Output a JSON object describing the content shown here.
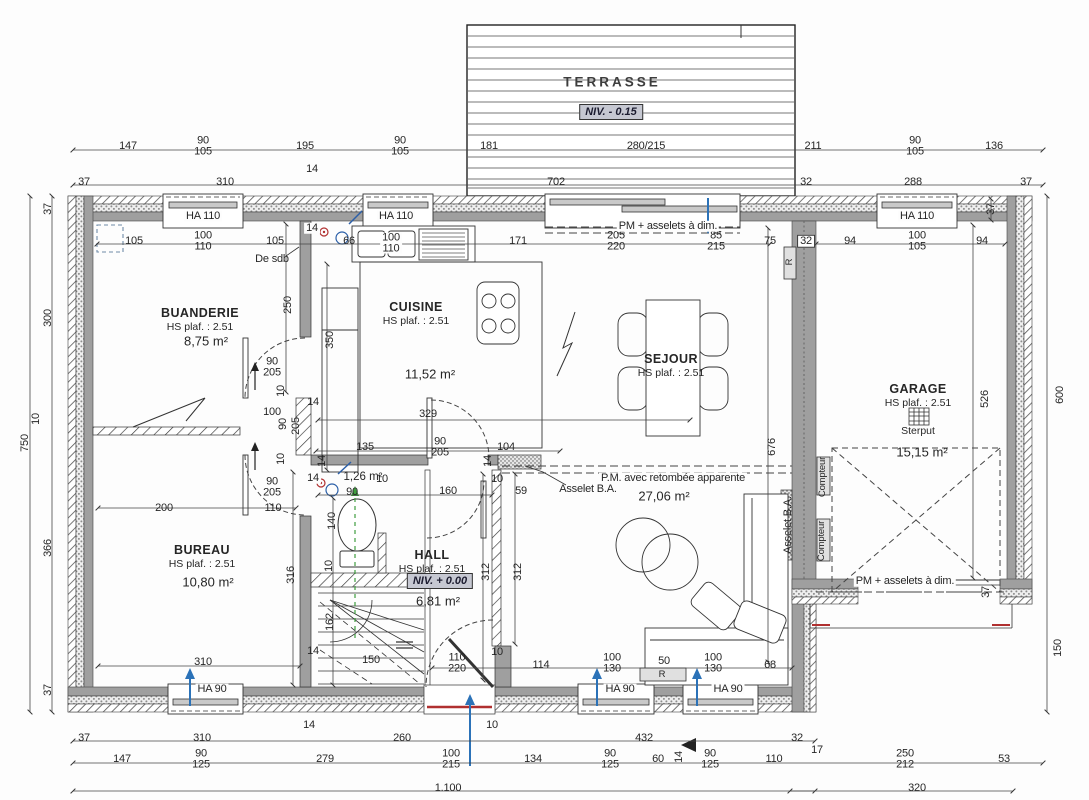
{
  "rooms": {
    "terrasse": {
      "name": "TERRASSE",
      "niv": "NIV. - 0.15"
    },
    "buanderie": {
      "name": "BUANDERIE",
      "ceiling": "HS plaf. : 2.51",
      "area": "8,75 m²"
    },
    "cuisine": {
      "name": "CUISINE",
      "ceiling": "HS plaf. : 2.51",
      "area": "11,52 m²"
    },
    "sejour": {
      "name": "SEJOUR",
      "ceiling": "HS plaf. : 2.51",
      "area": "27,06 m²"
    },
    "garage": {
      "name": "GARAGE",
      "ceiling": "HS plaf. : 2.51",
      "area": "15,15 m²",
      "drain": "Sterput"
    },
    "bureau": {
      "name": "BUREAU",
      "ceiling": "HS plaf. : 2.51",
      "area": "10,80 m²"
    },
    "hall": {
      "name": "HALL",
      "ceiling": "HS plaf. : 2.51",
      "niv": "NIV. + 0.00",
      "area": "6,81 m²"
    },
    "wc": {
      "area": "1,26 m²"
    }
  },
  "colors": {
    "wall": "#9f9f9f",
    "accent_blue": "#2b72b8",
    "accent_green": "#3f9e3f",
    "accent_red": "#b03030",
    "niv_bg": "#c6c8d2"
  },
  "dimension_labels": [
    {
      "t": "147",
      "x": 128,
      "y": 146
    },
    {
      "t": "90",
      "b": "105",
      "x": 203,
      "y": 146
    },
    {
      "t": "195",
      "x": 305,
      "y": 146
    },
    {
      "t": "90",
      "b": "105",
      "x": 400,
      "y": 146
    },
    {
      "t": "181",
      "x": 489,
      "y": 146
    },
    {
      "t": "280/215",
      "x": 646,
      "y": 146
    },
    {
      "t": "211",
      "x": 813,
      "y": 146
    },
    {
      "t": "90",
      "b": "105",
      "x": 915,
      "y": 146
    },
    {
      "t": "136",
      "x": 994,
      "y": 146
    },
    {
      "t": "37",
      "x": 84,
      "y": 182
    },
    {
      "t": "310",
      "x": 225,
      "y": 182
    },
    {
      "t": "14",
      "x": 312,
      "y": 169
    },
    {
      "t": "702",
      "x": 556,
      "y": 182
    },
    {
      "t": "32",
      "x": 806,
      "y": 182
    },
    {
      "t": "288",
      "x": 913,
      "y": 182
    },
    {
      "t": "37",
      "x": 1026,
      "y": 182
    },
    {
      "t": "105",
      "x": 134,
      "y": 241
    },
    {
      "t": "100",
      "b": "110",
      "x": 203,
      "y": 241
    },
    {
      "t": "105",
      "x": 275,
      "y": 241
    },
    {
      "t": "14",
      "x": 312,
      "y": 228,
      "c": "wbg"
    },
    {
      "t": "66",
      "x": 349,
      "y": 241
    },
    {
      "t": "100",
      "b": "110",
      "x": 391,
      "y": 243,
      "c": "wbg"
    },
    {
      "t": "171",
      "x": 518,
      "y": 241
    },
    {
      "t": "205",
      "b": "220",
      "x": 616,
      "y": 241
    },
    {
      "t": "85",
      "b": "215",
      "x": 716,
      "y": 241
    },
    {
      "t": "75",
      "x": 770,
      "y": 241
    },
    {
      "t": "32",
      "x": 806,
      "y": 241,
      "c": "box"
    },
    {
      "t": "94",
      "x": 850,
      "y": 241
    },
    {
      "t": "100",
      "b": "105",
      "x": 917,
      "y": 241
    },
    {
      "t": "94",
      "x": 982,
      "y": 241
    },
    {
      "t": "37",
      "x": 991,
      "y": 209,
      "r": 1
    },
    {
      "t": "37",
      "x": 48,
      "y": 209,
      "r": 1
    },
    {
      "t": "300",
      "x": 48,
      "y": 318,
      "r": 1
    },
    {
      "t": "10",
      "x": 36,
      "y": 419,
      "r": 1
    },
    {
      "t": "750",
      "x": 25,
      "y": 443,
      "r": 1
    },
    {
      "t": "366",
      "x": 48,
      "y": 548,
      "r": 1
    },
    {
      "t": "37",
      "x": 48,
      "y": 690,
      "r": 1
    },
    {
      "t": "600",
      "x": 1060,
      "y": 395,
      "r": 1
    },
    {
      "t": "150",
      "x": 1058,
      "y": 648,
      "r": 1
    },
    {
      "t": "526",
      "x": 985,
      "y": 399,
      "r": 1
    },
    {
      "t": "37",
      "x": 986,
      "y": 592,
      "r": 1
    },
    {
      "t": "676",
      "x": 772,
      "y": 447,
      "r": 1
    },
    {
      "t": "250",
      "x": 288,
      "y": 305,
      "r": 1
    },
    {
      "t": "90",
      "b": "205",
      "x": 272,
      "y": 367
    },
    {
      "t": "10",
      "x": 281,
      "y": 391,
      "r": 1
    },
    {
      "t": "100",
      "x": 272,
      "y": 412
    },
    {
      "t": "90",
      "x": 283,
      "y": 424,
      "r": 1
    },
    {
      "t": "205",
      "x": 296,
      "y": 426,
      "r": 1
    },
    {
      "t": "10",
      "x": 281,
      "y": 459,
      "r": 1
    },
    {
      "t": "14",
      "x": 313,
      "y": 402
    },
    {
      "t": "90",
      "b": "205",
      "x": 272,
      "y": 487
    },
    {
      "t": "110",
      "x": 273,
      "y": 508
    },
    {
      "t": "200",
      "x": 164,
      "y": 508
    },
    {
      "t": "350",
      "x": 330,
      "y": 340,
      "r": 1
    },
    {
      "t": "329",
      "x": 428,
      "y": 414
    },
    {
      "t": "135",
      "x": 365,
      "y": 447
    },
    {
      "t": "90",
      "b": "205",
      "x": 440,
      "y": 447
    },
    {
      "t": "104",
      "x": 506,
      "y": 447
    },
    {
      "t": "14",
      "x": 322,
      "y": 461,
      "r": 1
    },
    {
      "t": "14",
      "x": 488,
      "y": 461,
      "r": 1
    },
    {
      "t": "14",
      "x": 313,
      "y": 478,
      "c": "wbg"
    },
    {
      "t": "90",
      "x": 352,
      "y": 492
    },
    {
      "t": "10",
      "x": 382,
      "y": 479
    },
    {
      "t": "160",
      "x": 448,
      "y": 491
    },
    {
      "t": "140",
      "x": 332,
      "y": 521,
      "r": 1
    },
    {
      "t": "10",
      "x": 329,
      "y": 566,
      "r": 1
    },
    {
      "t": "162",
      "x": 330,
      "y": 622,
      "r": 1
    },
    {
      "t": "14",
      "x": 313,
      "y": 651
    },
    {
      "t": "150",
      "x": 371,
      "y": 660
    },
    {
      "t": "10",
      "x": 497,
      "y": 479
    },
    {
      "t": "59",
      "x": 521,
      "y": 491
    },
    {
      "t": "312",
      "x": 486,
      "y": 572,
      "r": 1
    },
    {
      "t": "312",
      "x": 518,
      "y": 572,
      "r": 1
    },
    {
      "t": "110",
      "b": "220",
      "x": 457,
      "y": 663
    },
    {
      "t": "10",
      "x": 497,
      "y": 652
    },
    {
      "t": "114",
      "x": 541,
      "y": 665
    },
    {
      "t": "316",
      "x": 291,
      "y": 575,
      "r": 1
    },
    {
      "t": "310",
      "x": 203,
      "y": 662
    },
    {
      "t": "100",
      "b": "130",
      "x": 612,
      "y": 663
    },
    {
      "t": "50",
      "x": 664,
      "y": 661
    },
    {
      "t": "100",
      "b": "130",
      "x": 713,
      "y": 663
    },
    {
      "t": "68",
      "x": 770,
      "y": 665
    },
    {
      "t": "37",
      "x": 84,
      "y": 738
    },
    {
      "t": "310",
      "x": 202,
      "y": 738
    },
    {
      "t": "14",
      "x": 309,
      "y": 725
    },
    {
      "t": "260",
      "x": 402,
      "y": 738
    },
    {
      "t": "10",
      "x": 492,
      "y": 725
    },
    {
      "t": "432",
      "x": 644,
      "y": 738
    },
    {
      "t": "32",
      "x": 797,
      "y": 738
    },
    {
      "t": "147",
      "x": 122,
      "y": 759
    },
    {
      "t": "90",
      "b": "125",
      "x": 201,
      "y": 759
    },
    {
      "t": "279",
      "x": 325,
      "y": 759
    },
    {
      "t": "100",
      "b": "215",
      "x": 451,
      "y": 759
    },
    {
      "t": "134",
      "x": 533,
      "y": 759
    },
    {
      "t": "90",
      "b": "125",
      "x": 610,
      "y": 759
    },
    {
      "t": "60",
      "x": 658,
      "y": 759
    },
    {
      "t": "14",
      "x": 679,
      "y": 757,
      "r": 1
    },
    {
      "t": "90",
      "b": "125",
      "x": 710,
      "y": 759
    },
    {
      "t": "110",
      "x": 774,
      "y": 759
    },
    {
      "t": "17",
      "x": 817,
      "y": 750
    },
    {
      "t": "250",
      "b": "212",
      "x": 905,
      "y": 759
    },
    {
      "t": "53",
      "x": 1004,
      "y": 759
    },
    {
      "t": "1.100",
      "x": 448,
      "y": 788
    },
    {
      "t": "320",
      "x": 917,
      "y": 788
    }
  ],
  "annotation_labels": [
    {
      "t": "HA 110",
      "x": 203,
      "y": 216,
      "c": "wbg"
    },
    {
      "t": "HA 110",
      "x": 396,
      "y": 216,
      "c": "wbg"
    },
    {
      "t": "HA 110",
      "x": 917,
      "y": 216,
      "c": "wbg"
    },
    {
      "t": "PM + asselets à dim.",
      "x": 668,
      "y": 226,
      "c": "wbg"
    },
    {
      "t": "De sdb",
      "x": 272,
      "y": 259
    },
    {
      "t": "HA 90",
      "x": 212,
      "y": 689,
      "c": "wbg"
    },
    {
      "t": "HA 90",
      "x": 620,
      "y": 689,
      "c": "wbg"
    },
    {
      "t": "HA 90",
      "x": 728,
      "y": 689,
      "c": "wbg"
    },
    {
      "t": "Asselet B.A.",
      "x": 588,
      "y": 489
    },
    {
      "t": "P.M.  avec retombée apparente",
      "x": 673,
      "y": 478,
      "c": "wbg"
    },
    {
      "t": "Asselet B.A.",
      "x": 788,
      "y": 525,
      "r": 1
    },
    {
      "t": "PM + asselets à dim.",
      "x": 905,
      "y": 581,
      "c": "wbg"
    },
    {
      "t": "Compteur",
      "x": 823,
      "y": 477,
      "r": 1,
      "c": "small"
    },
    {
      "t": "Compteur",
      "x": 822,
      "y": 541,
      "r": 1,
      "c": "small"
    },
    {
      "t": "R",
      "x": 790,
      "y": 262,
      "r": 1,
      "c": "small"
    },
    {
      "t": "R",
      "x": 662,
      "y": 675,
      "c": "small"
    }
  ]
}
